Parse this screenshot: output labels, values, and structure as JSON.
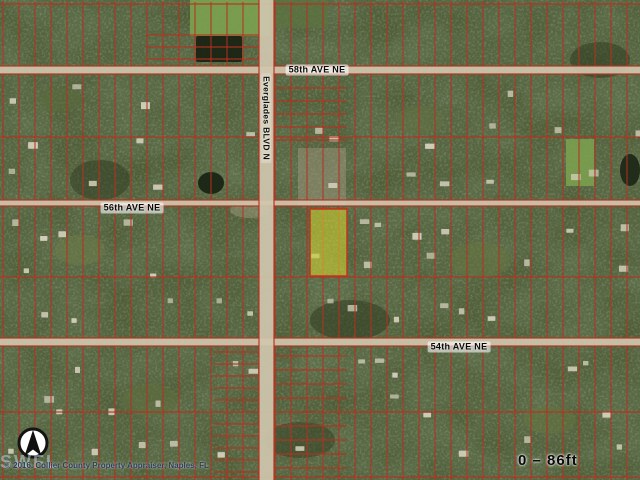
{
  "map": {
    "background_color": "#4a5530",
    "grid_color": "#b5321f",
    "road_color": "#cfc7ae",
    "highlight_color": "#dede30",
    "roads": [
      {
        "id": "ave-58",
        "label": "58th AVE NE",
        "orientation": "horizontal",
        "y": 66,
        "thickness": 8,
        "label_x": 317,
        "label_y": 70
      },
      {
        "id": "ave-56",
        "label": "56th AVE NE",
        "orientation": "horizontal",
        "y": 200,
        "thickness": 6,
        "label_x": 132,
        "label_y": 208
      },
      {
        "id": "ave-54",
        "label": "54th AVE NE",
        "orientation": "horizontal",
        "y": 338,
        "thickness": 8,
        "label_x": 459,
        "label_y": 347
      },
      {
        "id": "everglades-blvd",
        "label": "Everglades BLVD N",
        "orientation": "vertical",
        "x": 259,
        "thickness": 15,
        "label_x": 266,
        "label_y": 118
      }
    ],
    "grid": {
      "vertical_start": 3,
      "vertical_spacing": 16,
      "horizontal_lines": [
        4,
        137,
        277,
        412,
        477
      ],
      "sub_strips": [
        {
          "x1": 146,
          "x2": 259,
          "ys": [
            35,
            47,
            59
          ]
        },
        {
          "x1": 275,
          "x2": 347,
          "ys": [
            88,
            101,
            114,
            127,
            140
          ]
        },
        {
          "x1": 214,
          "x2": 259,
          "ys": [
            352,
            364,
            376,
            388,
            400,
            424,
            436,
            448,
            460,
            472
          ]
        },
        {
          "x1": 275,
          "x2": 347,
          "ys": [
            356,
            370,
            384,
            398,
            426,
            440,
            454,
            468
          ]
        }
      ]
    },
    "highlight_parcel": {
      "x": 310,
      "y": 209,
      "width": 37,
      "height": 67
    },
    "north_arrow": {
      "cx": 33,
      "cy": 443,
      "r": 14
    },
    "scale_label": "0 – 86ft",
    "attribution": "© 2016. Collier County Property Appraiser, Naples, FL",
    "watermark": "SWFL"
  }
}
